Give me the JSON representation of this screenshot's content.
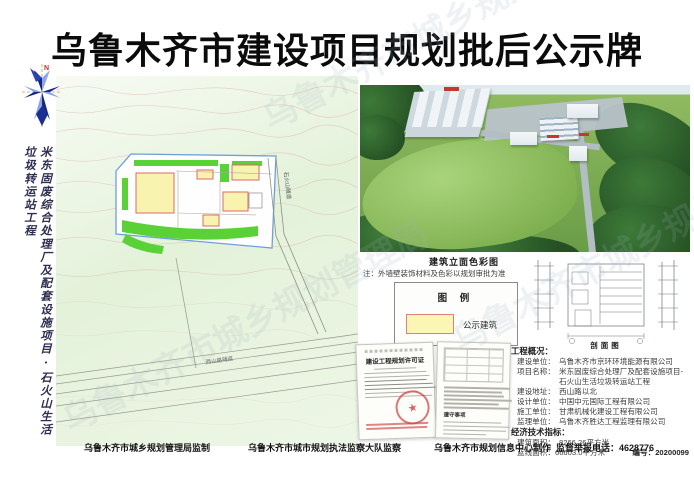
{
  "page": {
    "title": "乌鲁木齐市建设项目规划批后公示牌",
    "watermark": "乌鲁木齐市城乡规划管理局"
  },
  "left": {
    "compass_label": "N",
    "vertical_title": "米东固废综合处理厂及配套设施项目·石火山生活垃圾转运站工程"
  },
  "site_plan": {
    "road_right": "石火山隧道",
    "road_bottom": "西山路辅道"
  },
  "rendering": {
    "caption": "建筑立面色彩图",
    "note": "注：外墙壁装饰材料及色彩以规划审批为准"
  },
  "legend": {
    "title": "图 例",
    "items": [
      {
        "label": "公示建筑",
        "swatch_color": "#fcf6b4",
        "swatch_border": "#e07f7f"
      }
    ]
  },
  "elevation": {
    "caption": "剖面图"
  },
  "documents": [
    {
      "title": "建设工程规划许可证",
      "stamp_glyph": "★"
    },
    {
      "title": "遵守事项"
    }
  ],
  "info": {
    "heading": "工程概况：",
    "fields": [
      {
        "label": "建设单位：",
        "value": "乌鲁木齐市京环环境能源有限公司"
      },
      {
        "label": "项目名称：",
        "value": "米东固废综合处理厂及配套设施项目-石火山生活垃圾转运站工程"
      },
      {
        "label": "建设地址：",
        "value": "西山路以北"
      },
      {
        "label": "设计单位：",
        "value": "中国中元国际工程有限公司"
      },
      {
        "label": "施工单位：",
        "value": "甘肃机械化建设工程有限公司"
      },
      {
        "label": "监理单位：",
        "value": "乌鲁木齐胜达工程监理有限公司"
      }
    ],
    "indicators_heading": "经济技术指标：",
    "indicators": [
      {
        "label": "建筑面积：",
        "value": "8266.26平方米"
      },
      {
        "label": "蓝线面积：",
        "value": "66603.0平方米"
      }
    ],
    "serial": "编号：20200099"
  },
  "footer": {
    "items": [
      "乌鲁木齐市城乡规划管理局监制",
      "乌鲁木齐市城市规划执法监察大队监察",
      "乌鲁木齐市规划信息中心制作",
      "监督举报电话：4628776"
    ]
  }
}
